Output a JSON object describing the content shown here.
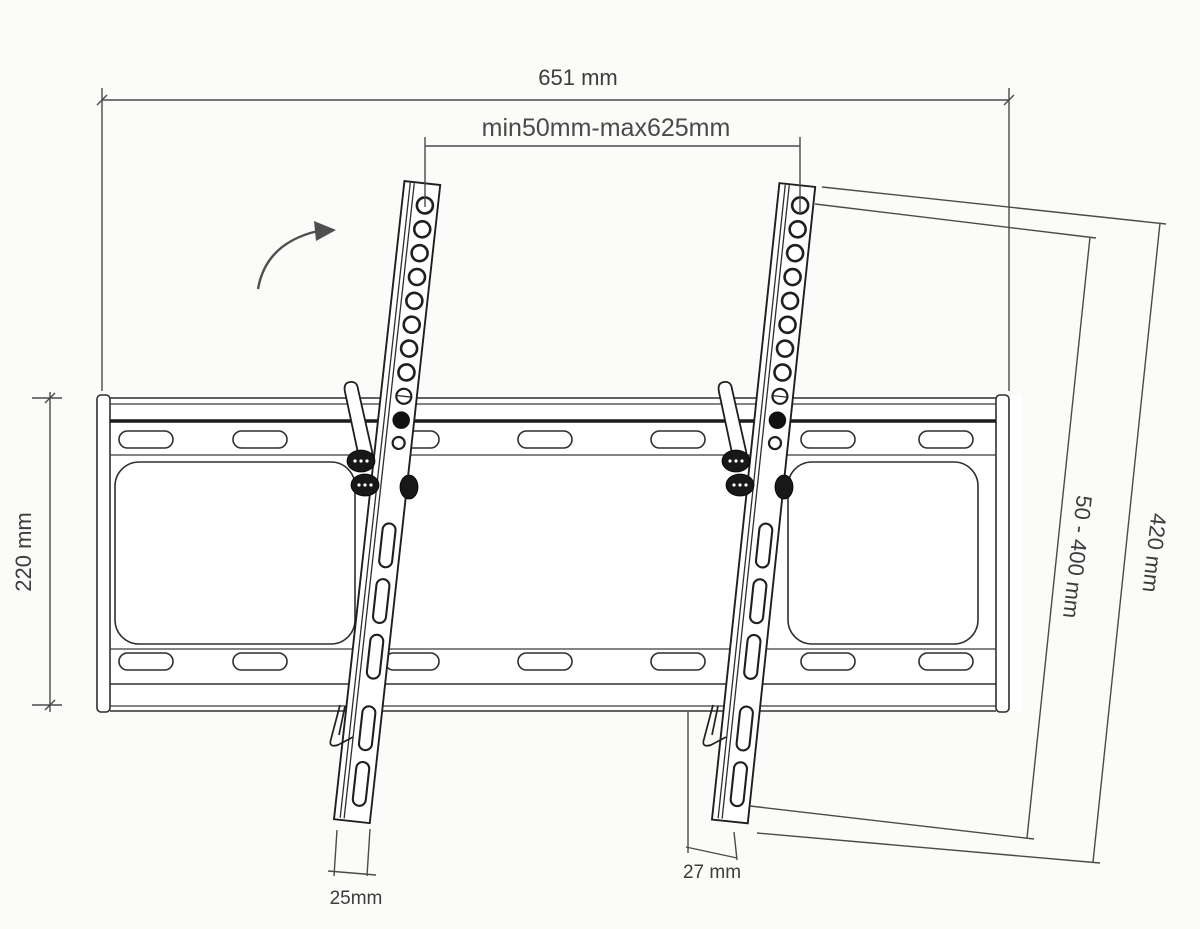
{
  "diagram": {
    "type": "technical-drawing",
    "subject": "Tilting TV wall-mount bracket, dimensioned line drawing",
    "background_color": "#fbfbf9",
    "line_color": "#2e2e2e",
    "dimension_line_color": "#4a4a4a",
    "text_color": "#3c3c3c"
  },
  "dimensions": {
    "total_width": {
      "label": "651 mm"
    },
    "rail_spacing_range": {
      "label": "min50mm-max625mm"
    },
    "wall_plate_height": {
      "label": "220 mm"
    },
    "vesa_height_range": {
      "label": "50 - 400 mm"
    },
    "rail_length": {
      "label": "420 mm"
    },
    "rail_width": {
      "label": "25mm"
    },
    "rail_bottom_offset": {
      "label": "27 mm"
    }
  },
  "annotations": {
    "tilt_arrow": "curved-arrow-up-right"
  }
}
